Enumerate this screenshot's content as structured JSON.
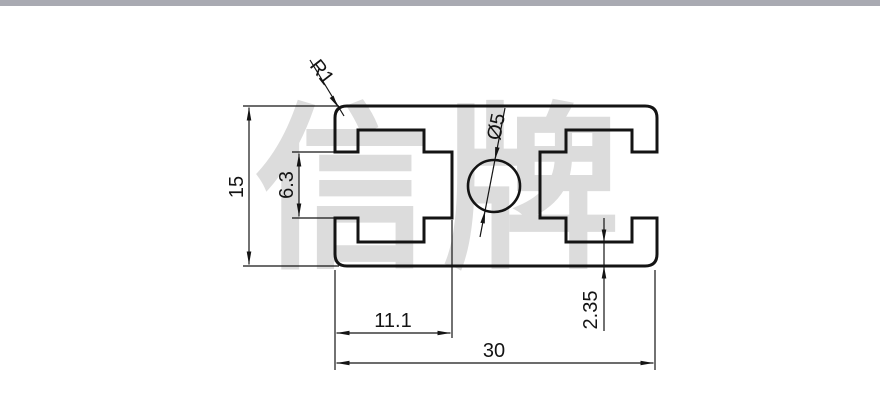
{
  "chrome": {
    "top_bar_color": "#a9aab2"
  },
  "watermark": {
    "text": "信牌",
    "color": "#dcdcdc"
  },
  "drawing": {
    "type": "profile-cross-section",
    "line_color": "#141414",
    "dimensions": {
      "overall_width": "30",
      "overall_height": "15",
      "slot_opening": "6.3",
      "slot_depth": "11.1",
      "wall_thickness": "2.35",
      "corner_radius": "R1",
      "hole_diameter": "Ø5"
    }
  }
}
